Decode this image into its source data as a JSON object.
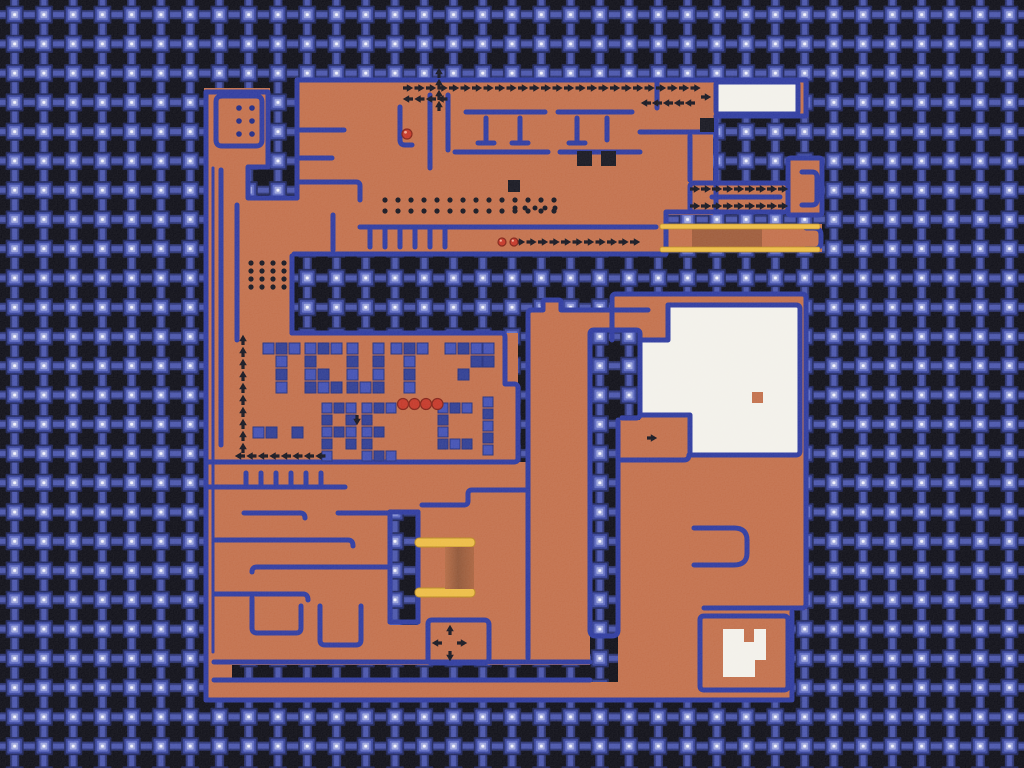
{
  "meta": {
    "scene": "game-map-screenshot",
    "title_text": "TEUT -RE"
  },
  "colors": {
    "bg": "#05050e",
    "bar_outer": "#232c6e",
    "bar_core": "#434fa8",
    "rivet": [
      "#151c52",
      "#2f3c96",
      "#5a67c0",
      "#9aa3dc",
      "#f4f4fc"
    ],
    "floor": "#c06a44",
    "floor_dark": "#9a5533",
    "wall": "#26339b",
    "letter": "#3b4ab0",
    "letter_dark": "#27368e",
    "yellow": "#ecba3e",
    "yellow_dark": "#b5841c",
    "red": "#c23020",
    "red_dark": "#7d1a0e",
    "mark": "#0e0e18",
    "white_room": "#f2f0e9"
  },
  "map": {
    "title_text": "TEUT -RE",
    "floor_regions": [
      [
        295,
        78,
        418,
        137
      ],
      [
        708,
        78,
        100,
        40
      ],
      [
        295,
        215,
        370,
        41
      ],
      [
        204,
        198,
        93,
        58
      ],
      [
        204,
        88,
        66,
        79
      ],
      [
        204,
        160,
        44,
        96
      ],
      [
        204,
        253,
        88,
        80
      ],
      [
        204,
        333,
        314,
        132
      ],
      [
        204,
        462,
        326,
        52
      ],
      [
        204,
        512,
        186,
        115
      ],
      [
        418,
        512,
        112,
        115
      ],
      [
        204,
        625,
        326,
        40
      ],
      [
        204,
        660,
        28,
        42
      ],
      [
        204,
        682,
        456,
        20
      ],
      [
        528,
        310,
        62,
        355
      ],
      [
        543,
        300,
        18,
        12
      ],
      [
        590,
        310,
        65,
        22
      ],
      [
        612,
        294,
        194,
        38
      ],
      [
        640,
        330,
        166,
        130
      ],
      [
        618,
        420,
        188,
        190
      ],
      [
        618,
        608,
        174,
        94
      ],
      [
        658,
        224,
        164,
        28
      ],
      [
        690,
        183,
        98,
        29
      ],
      [
        788,
        158,
        34,
        57
      ]
    ],
    "dark_regions": [
      [
        692,
        224,
        70,
        28
      ]
    ],
    "white_rects": [
      [
        716,
        82,
        82,
        32
      ]
    ],
    "white_paths": [
      "M668,305 H796 Q800,305 800,309 V451 Q800,455 796,455 H690 V415 H640 V340 H668 Z",
      "M723,629 H744 V642 H754 V629 H766 V660 H755 V677 H723 Z"
    ],
    "orange_squares": [
      [
        752,
        392,
        11
      ]
    ],
    "walls": [
      "M294,254 H666 V212 H716 V116 H806 V80 H297 V198",
      "M297,198 H248 V167 H268 V92 H206",
      "M206,92 V700",
      "M292,256 V333",
      "M292,333 H501 Q505,333 505,337 V384 H514 Q518,384 518,388 V458 Q518,462 514,462 H206",
      "M206,487 H345",
      "M246,473 V487",
      "M261,473 V487",
      "M276,473 V487",
      "M291,473 V487",
      "M306,473 V487",
      "M321,473 V487",
      "M528,658 V314 Q528,310 532,310 H543 V302 Q543,300 545,300 H559 Q561,300 561,302 V310 H648",
      "M590,630 V334 Q590,330 594,330 H636 Q640,330 640,334 V414 Q640,418 636,418 H622",
      "M618,420 V630",
      "M590,630 Q590,636 596,636 H612 Q618,636 618,630",
      "M612,340 V298 Q612,294 616,294 H802 Q806,294 806,298 V604 Q806,608 802,608 H704",
      "M792,612 V700",
      "M704,690 Q700,690 700,686 V620 Q700,616 704,616 H784 Q788,616 788,620 V686 Q788,690 784,690 Z",
      "M668,305 H796 Q800,305 800,309 V451 Q800,455 796,455 H690 V415 H640 V340 H668 Z",
      "M719,82 Q716,82 716,85 V111 Q716,114 719,114 H795 Q798,114 798,111 V85 Q798,82 795,82 Z",
      "M694,528 H734 Q747,528 747,540 V553 Q747,565 734,565 H694",
      "M214,662 H590",
      "M214,680 H590",
      "M206,700 H790",
      "M244,513 H300 Q305,513 305,518",
      "M338,513 H388",
      "M214,540 H348 Q353,540 353,546",
      "M252,572 Q252,567 257,567 H388",
      "M214,594 H303 Q308,594 308,600",
      "M252,598 V628 Q252,633 257,633 H296 Q301,633 301,628 V606",
      "M320,606 V640 Q320,645 325,645 H356 Q361,645 361,640 V606",
      "M221,170 V445",
      "M237,205 V340",
      "M400,107 V140 Q400,145 405,145 H412",
      "M430,95 V168",
      "M448,95 V150",
      "M466,112 H545",
      "M486,118 V140",
      "M478,143 H494",
      "M520,118 V140",
      "M512,143 H528",
      "M558,112 H632",
      "M577,118 V140",
      "M569,143 H585",
      "M607,118 V140",
      "M455,152 H548",
      "M560,152 H640",
      "M300,130 H344",
      "M300,158 H332",
      "M300,182 H356 Q360,182 360,186 V200",
      "M333,215 V250",
      "M360,227 H656",
      "M370,229 V247",
      "M385,229 V247",
      "M400,229 V247",
      "M415,229 V247",
      "M430,229 V247",
      "M445,229 V247",
      "M657,80 V108",
      "M640,132 H713",
      "M690,136 V180",
      "M694,183 Q690,183 690,187 V208 Q690,212 694,212 H784 Q788,212 788,208 V187 Q788,183 784,183 Z",
      "M712,197 H780",
      "M791,158 Q788,158 788,161 V212 Q788,215 791,215 H819 Q822,215 822,212 V161 Q822,158 819,158 Z",
      "M802,172 H812 Q817,172 817,177 V200 Q817,205 812,205 H802",
      "M222,96 Q216,96 216,102 V140 Q216,146 222,146 H256 Q262,146 262,140 V102 Q262,96 256,96 Z",
      "M806,228 H814 Q821,228 821,235 V242 Q821,249 814,249 H806",
      "M620,460 H684 Q689,460 689,455",
      "M418,512 V622",
      "M390,512 V622",
      "M390,512 H418",
      "M390,622 H418",
      "M422,505 H464 Q468,505 468,501 V494 Q468,490 472,490 H528",
      "M432,663 Q428,663 428,659 V624 Q428,620 432,620 H484 Q489,620 489,625 V658 Q489,663 484,663 Z"
    ],
    "thin_walls": [
      "M213,168 V652"
    ],
    "letters": {
      "glyphs": {
        "T": [
          "XXX",
          ".X.",
          ".X.",
          ".X."
        ],
        "E4": [
          "XXX",
          "X..",
          "XX.",
          "XXX"
        ],
        "U": [
          "X.X",
          "X.X",
          "X.X",
          "XXX"
        ],
        "7": [
          "XXX",
          "..X",
          ".X."
        ],
        "I2": [
          "X",
          "X"
        ],
        "-": [
          "XX.X"
        ],
        "R": [
          "XXX",
          "X.X",
          "XXX",
          "X.X",
          "X.."
        ],
        "E5": [
          "XXX",
          "X..",
          "XX.",
          "X..",
          "XXX"
        ],
        "LB": [
          "XXX",
          "X..",
          "X..",
          "XXX"
        ],
        "I5": [
          "X",
          "X",
          "X",
          "X",
          "X"
        ]
      },
      "items": [
        [
          "T",
          263,
          343,
          13
        ],
        [
          "E4",
          305,
          343,
          13
        ],
        [
          "U",
          347,
          343,
          13
        ],
        [
          "T",
          391,
          343,
          13
        ],
        [
          "7",
          445,
          343,
          13
        ],
        [
          "I2",
          483,
          343,
          13
        ],
        [
          "-",
          253,
          427,
          13
        ],
        [
          "R",
          322,
          403,
          12
        ],
        [
          "E5",
          362,
          403,
          12
        ],
        [
          "LB",
          438,
          403,
          12
        ],
        [
          "I5",
          483,
          397,
          12
        ]
      ]
    },
    "arrow_chains": [
      [
        408,
        88,
        "r",
        26,
        11.5
      ],
      [
        408,
        99,
        "l",
        4,
        11.5
      ],
      [
        646,
        103,
        "l",
        5,
        11
      ],
      [
        439,
        106,
        "u",
        4,
        11
      ],
      [
        706,
        97,
        "r",
        1,
        0
      ],
      [
        520,
        242,
        "r",
        11,
        11.5
      ],
      [
        695,
        189,
        "r",
        9,
        11
      ],
      [
        695,
        206,
        "r",
        9,
        11
      ],
      [
        243,
        448,
        "u",
        10,
        12
      ],
      [
        240,
        456,
        "l",
        8,
        11.5
      ],
      [
        652,
        438,
        "r",
        1,
        0
      ],
      [
        450,
        630,
        "u",
        1,
        0
      ],
      [
        437,
        643,
        "l",
        1,
        0
      ],
      [
        462,
        643,
        "r",
        1,
        0
      ],
      [
        450,
        656,
        "d",
        1,
        0
      ],
      [
        357,
        420,
        "d",
        1,
        0
      ]
    ],
    "dot_grids": [
      [
        385,
        200,
        14,
        2,
        13,
        11,
        2.6,
        null
      ],
      [
        251,
        263,
        4,
        4,
        11,
        8,
        2.6,
        null
      ],
      [
        515,
        208,
        5,
        1,
        10,
        1,
        2.5,
        null
      ],
      [
        239,
        108,
        2,
        3,
        13,
        13,
        2.8,
        "#18227e"
      ]
    ],
    "black_squares": [
      [
        700,
        118,
        14
      ],
      [
        577,
        151,
        15
      ],
      [
        601,
        151,
        15
      ],
      [
        508,
        180,
        12
      ]
    ],
    "red_balls": [
      [
        407,
        134,
        5
      ],
      [
        502,
        242,
        4
      ],
      [
        514,
        242,
        4
      ]
    ],
    "red_chain": {
      "x": 403,
      "y": 404,
      "n": 4,
      "step": 11.5,
      "r": 5.5
    },
    "spool_vertical": {
      "flanges": [
        [
          415,
          538,
          60,
          9
        ],
        [
          415,
          588,
          60,
          9
        ]
      ],
      "body": [
        445,
        547,
        29,
        42
      ]
    },
    "spool_bar": {
      "lines": [
        [
          660,
          224,
          160,
          5
        ],
        [
          660,
          247,
          160,
          5
        ]
      ]
    }
  },
  "pattern": {
    "tile": 29.26,
    "square": 18,
    "bar": 9,
    "bar_core": 5
  }
}
